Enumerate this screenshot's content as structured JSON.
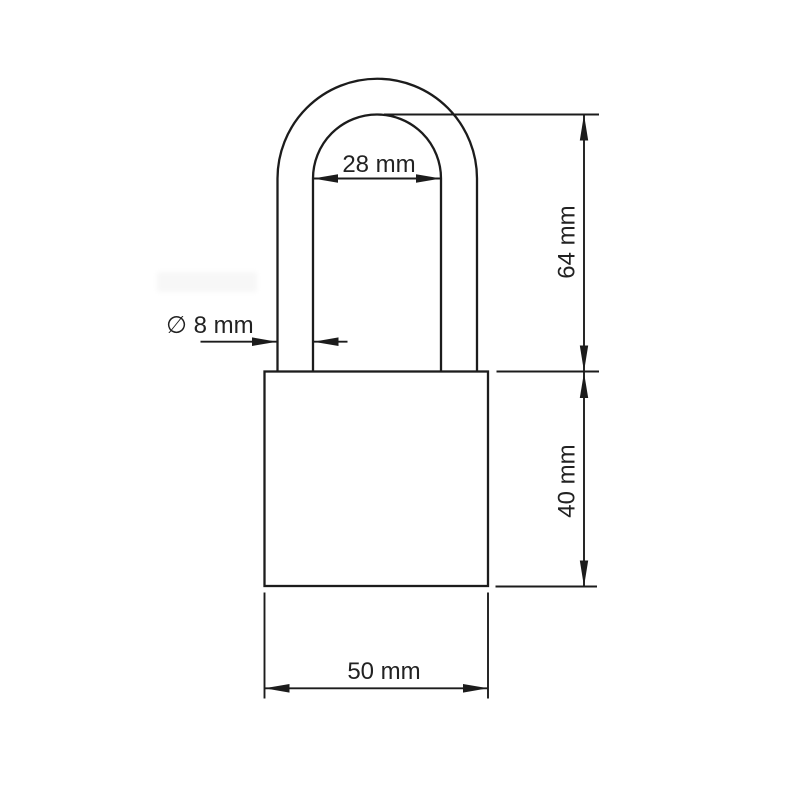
{
  "page": {
    "background_color": "#ffffff"
  },
  "drawing": {
    "subject": "padlock outline technical drawing",
    "line_color": "#1c1c1c",
    "text_color": "#222222",
    "dimensions": {
      "shackle_inner_width": {
        "label": "28 mm",
        "value_mm": 28
      },
      "shackle_height": {
        "label": "64 mm",
        "value_mm": 64
      },
      "shackle_diameter": {
        "label": "∅ 8 mm",
        "value_mm": 8
      },
      "body_height": {
        "label": "40 mm",
        "value_mm": 40
      },
      "body_width": {
        "label": "50 mm",
        "value_mm": 50
      }
    }
  }
}
